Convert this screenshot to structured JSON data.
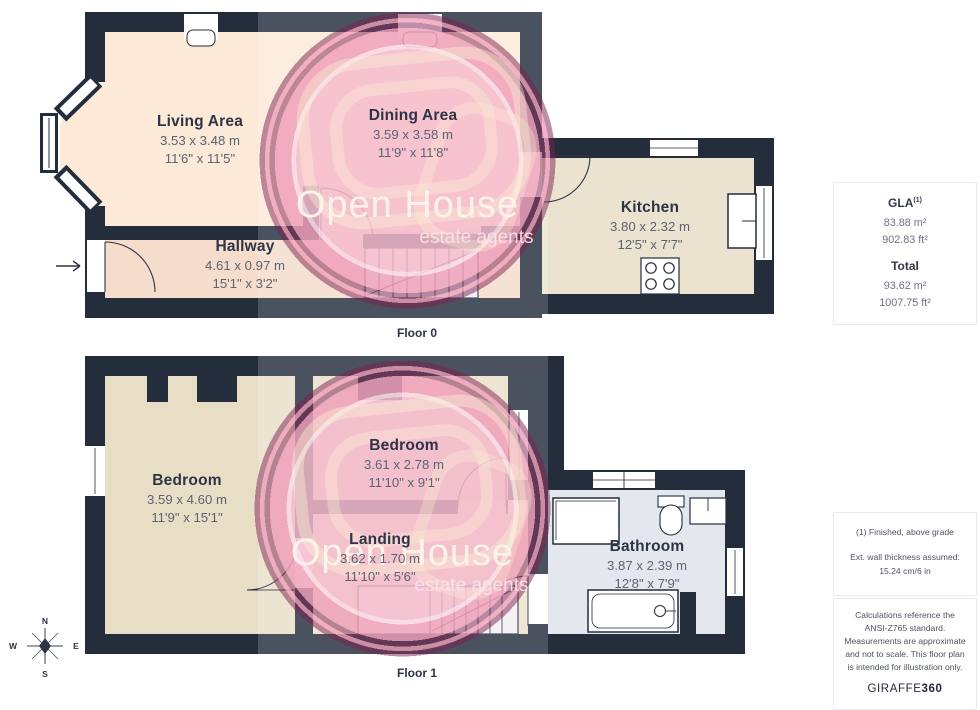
{
  "floors": [
    {
      "label": "Floor 0",
      "rooms": [
        {
          "name": "Living Area",
          "size_m": "3.53 x 3.48 m",
          "size_ft": "11'6\" x 11'5\""
        },
        {
          "name": "Dining Area",
          "size_m": "3.59 x 3.58 m",
          "size_ft": "11'9\" x 11'8\""
        },
        {
          "name": "Kitchen",
          "size_m": "3.80 x 2.32 m",
          "size_ft": "12'5\" x 7'7\""
        },
        {
          "name": "Hallway",
          "size_m": "4.61 x 0.97 m",
          "size_ft": "15'1\" x 3'2\""
        }
      ]
    },
    {
      "label": "Floor 1",
      "rooms": [
        {
          "name": "Bedroom",
          "size_m": "3.59 x 4.60 m",
          "size_ft": "11'9\" x 15'1\""
        },
        {
          "name": "Bedroom",
          "size_m": "3.61 x 2.78 m",
          "size_ft": "11'10\" x 9'1\""
        },
        {
          "name": "Landing",
          "size_m": "3.62 x 1.70 m",
          "size_ft": "11'10\" x 5'6\""
        },
        {
          "name": "Bathroom",
          "size_m": "3.87 x 2.39 m",
          "size_ft": "12'8\" x 7'9\""
        }
      ]
    }
  ],
  "sidebar": {
    "gla_label": "GLA",
    "gla_sup": "(1)",
    "gla_m2": "83.88 m²",
    "gla_ft2": "902.83 ft²",
    "total_label": "Total",
    "total_m2": "93.62 m²",
    "total_ft2": "1007.75 ft²",
    "footnote1": "(1) Finished, above grade",
    "footnote2": "Ext. wall thickness assumed: 15.24 cm/6 in",
    "disclaimer": "Calculations reference the ANSI-Z765 standard. Measurements are approximate and not to scale. This floor plan is intended for illustration only.",
    "brand": "GIRAFFE",
    "brand_suffix": "360"
  },
  "watermark": {
    "line1": "Open House",
    "line2": "estate agents"
  },
  "compass": {
    "n": "N",
    "e": "E",
    "s": "S",
    "w": "W"
  },
  "colors": {
    "wall": "#242d3c",
    "living": "#fce9d8",
    "hallway": "#f5dccb",
    "kitchen": "#ebe3cf",
    "bedroom": "#e8dec6",
    "bathroom": "#e4e8ee",
    "watermark_pink": "#efa0b8",
    "text_navy": "#2d3447"
  }
}
